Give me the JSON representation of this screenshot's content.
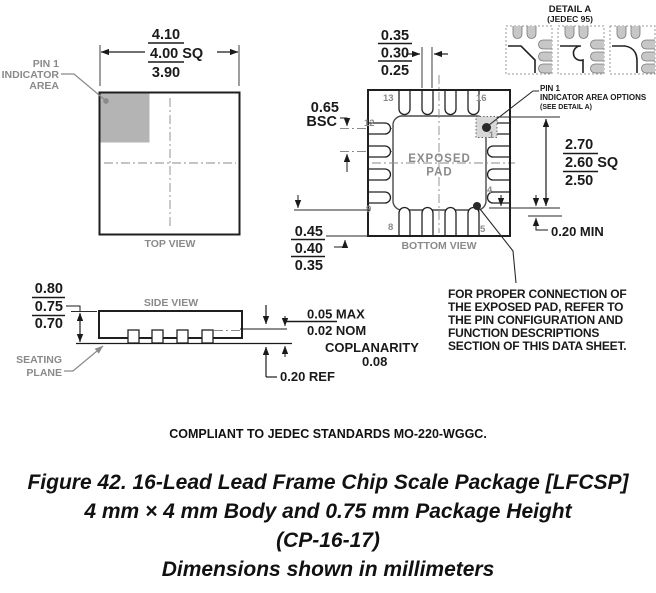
{
  "colors": {
    "line": "#1a1a1a",
    "gray_fill": "#b4b4b4",
    "gray_text": "#8a8a8a",
    "pad_fill": "#d8d8d8"
  },
  "top_view": {
    "label": "TOP VIEW",
    "pin1_area": [
      "PIN 1",
      "INDICATOR",
      "AREA"
    ],
    "body_dim": {
      "max": "4.10",
      "nom": "4.00 SQ",
      "min": "3.90"
    }
  },
  "side_view": {
    "label": "SIDE VIEW",
    "height_dim": {
      "max": "0.80",
      "nom": "0.75",
      "min": "0.70"
    },
    "seating_plane": [
      "SEATING",
      "PLANE"
    ],
    "standoff": {
      "max": "0.05 MAX",
      "nom": "0.02 NOM"
    },
    "coplanarity": {
      "label": "COPLANARITY",
      "value": "0.08"
    },
    "lead_thickness": "0.20 REF"
  },
  "bottom_view": {
    "label": "BOTTOM VIEW",
    "exposed_pad": [
      "EXPOSED",
      "PAD"
    ],
    "lead_width_dim": {
      "max": "0.35",
      "nom": "0.30",
      "min": "0.25"
    },
    "pitch": {
      "value": "0.65",
      "qual": "BSC"
    },
    "lead_length_dim": {
      "max": "0.45",
      "nom": "0.40",
      "min": "0.35"
    },
    "pad_dim": {
      "max": "2.70",
      "nom": "2.60 SQ",
      "min": "2.50"
    },
    "pad_to_lead": "0.20 MIN",
    "pins": {
      "n13": "13",
      "n16": "16",
      "n12": "12",
      "n9": "9",
      "n8": "8",
      "n5": "5",
      "n4": "4",
      "n1": "1"
    },
    "pin1_options": [
      "PIN 1",
      "INDICATOR AREA OPTIONS",
      "(SEE DETAIL A)"
    ],
    "note": [
      "FOR PROPER CONNECTION OF",
      "THE EXPOSED PAD, REFER TO",
      "THE PIN CONFIGURATION AND",
      "FUNCTION DESCRIPTIONS",
      "SECTION OF THIS DATA SHEET."
    ]
  },
  "detail_a": {
    "title": "DETAIL A",
    "subtitle": "(JEDEC 95)"
  },
  "footer": {
    "compliance": "COMPLIANT TO JEDEC STANDARDS MO-220-WGGC.",
    "caption": [
      "Figure 42. 16-Lead Lead Frame Chip Scale Package [LFCSP]",
      "4 mm × 4 mm Body and 0.75 mm Package Height",
      "(CP-16-17)",
      "Dimensions shown in millimeters"
    ]
  }
}
